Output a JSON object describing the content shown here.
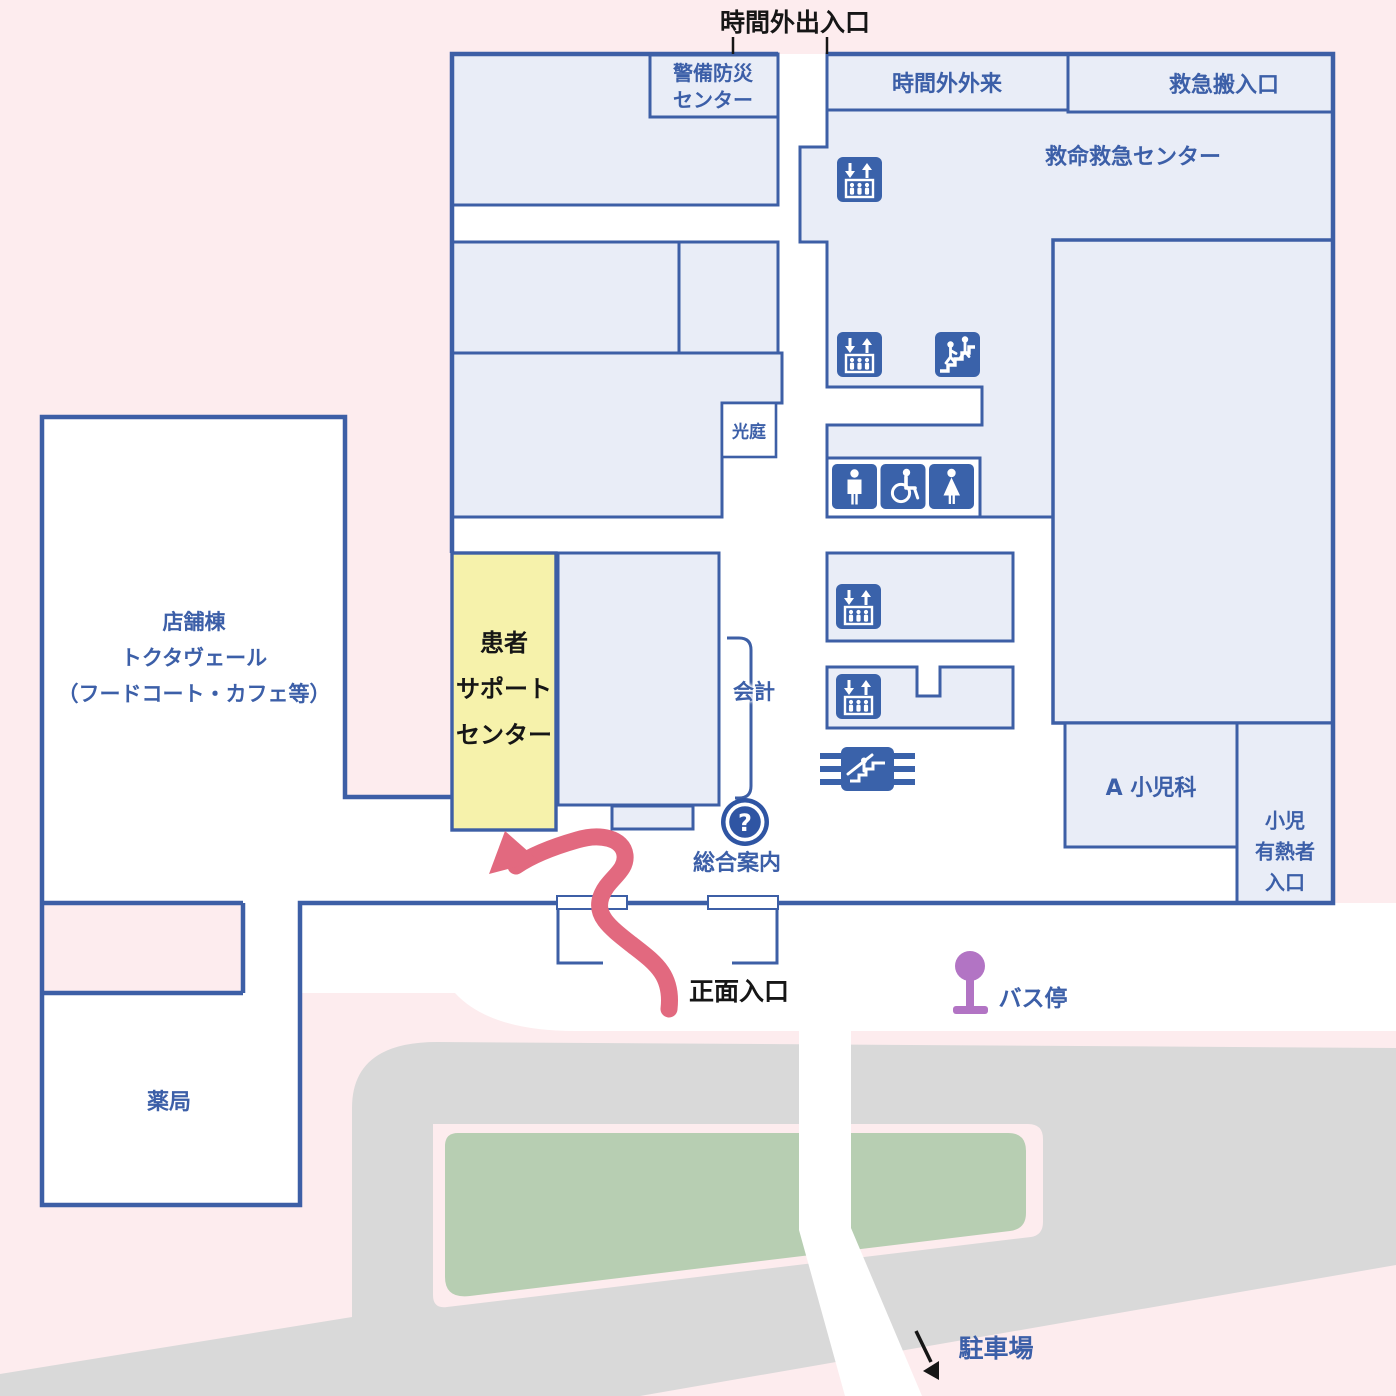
{
  "map_title": "病院フロアマップ 1F",
  "colors": {
    "background_pink": "#fdecee",
    "building_fill": "#e9edf7",
    "outline_blue": "#3d5fa6",
    "text_blue": "#3c5fa8",
    "text_black": "#161616",
    "accent_yellow": "#f6f2ab",
    "route_pink": "#e2697f",
    "bus_purple": "#b274c4",
    "road_gray": "#d9d9d9",
    "lawn_green": "#b7ceb2",
    "icon_blue": "#3a62aa"
  },
  "areas": {
    "entrance_top": "時間外出入口",
    "security_lines": [
      "警備防災",
      "センター"
    ],
    "after_hours_outpatient": "時間外外来",
    "ambulance_entrance": "救急搬入口",
    "emergency_center": "救命救急センター",
    "light_court": "光庭",
    "cashier": "会計",
    "patient_support_lines": [
      "患者",
      "サポート",
      "センター"
    ],
    "shop_lines": [
      "店舗棟",
      "トクタヴェール",
      "（フードコート・カフェ等）"
    ],
    "info_desk": "総合案内",
    "main_entrance": "正面入口",
    "bus_stop": "バス停",
    "pediatrics": "A 小児科",
    "pediatric_fever_lines": [
      "小児",
      "有熱者",
      "入口"
    ],
    "pharmacy": "薬局",
    "parking": "駐車場",
    "question_mark": "?"
  },
  "icons": {
    "elevator": "elevator-icon",
    "stairs": "stairs-icon",
    "mens_restroom": "mens-restroom-icon",
    "accessible_restroom": "wheelchair-icon",
    "womens_restroom": "womens-restroom-icon",
    "escalator": "escalator-icon",
    "information": "question-mark-icon",
    "bus_stop": "bus-stop-icon",
    "route_arrow": "route-arrow-icon",
    "parking_arrow": "parking-arrow-icon"
  }
}
